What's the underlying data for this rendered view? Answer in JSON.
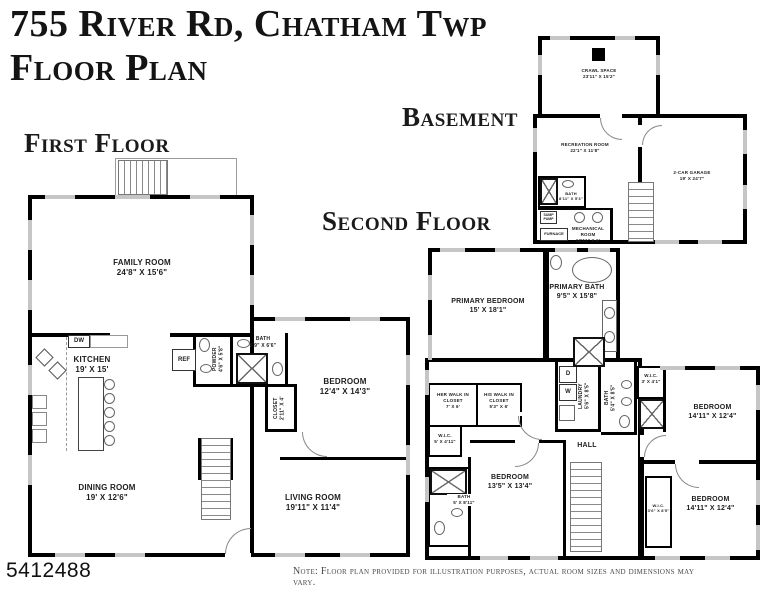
{
  "title": {
    "line1": "755 River Rd, Chatham Twp",
    "line2": "Floor Plan"
  },
  "section_labels": {
    "first_floor": "First Floor",
    "second_floor": "Second Floor",
    "basement": "Basement"
  },
  "colors": {
    "wall": "#000000",
    "window": "#c6c6c6",
    "background": "#ffffff"
  },
  "first_floor": {
    "family_room": {
      "name": "FAMILY ROOM",
      "dims": "24'8\" X 15'6\""
    },
    "kitchen": {
      "name": "KITCHEN",
      "dims": "19' X 15'"
    },
    "dishwasher_label": "DW",
    "refrigerator_label": "REF",
    "powder": {
      "name": "POWDER",
      "dims": "4'6\" X 5'8\""
    },
    "bath": {
      "name": "BATH",
      "dims": "8'9\" X 6'6\""
    },
    "closet": {
      "name": "CLOSET",
      "dims": "2'11\" X 4'"
    },
    "bedroom": {
      "name": "BEDROOM",
      "dims": "12'4\" X 14'3\""
    },
    "dining_room": {
      "name": "DINING ROOM",
      "dims": "19' X 12'6\""
    },
    "living_room": {
      "name": "LIVING ROOM",
      "dims": "19'11\" X 11'4\""
    }
  },
  "second_floor": {
    "primary_bedroom": {
      "name": "PRIMARY BEDROOM",
      "dims": "15' X 18'1\""
    },
    "primary_bath": {
      "name": "PRIMARY BATH",
      "dims": "9'5\" X 15'8\""
    },
    "her_closet": {
      "name": "HER WALK IN CLOSET",
      "dims": "7' X 6'"
    },
    "his_closet": {
      "name": "HIS WALK IN CLOSET",
      "dims": "5'3\" X 6'"
    },
    "wic_left": {
      "name": "W.I.C.",
      "dims": "5' X 4'11\""
    },
    "laundry": {
      "name": "LAUNDRY",
      "dims": "5'6\" X 8'5\""
    },
    "dryer_label": "D",
    "washer_label": "W",
    "bath_middle": {
      "name": "BATH",
      "dims": "5'4\" X 8'5\""
    },
    "wic_right": {
      "name": "W.I.C.",
      "dims": "3' X 4'1\""
    },
    "bedroom_upper_right": {
      "name": "BEDROOM",
      "dims": "14'11\" X 12'4\""
    },
    "bedroom_lower_right": {
      "name": "BEDROOM",
      "dims": "14'11\" X 12'4\""
    },
    "bedroom_middle": {
      "name": "BEDROOM",
      "dims": "13'5\" X 13'4\""
    },
    "bath_lower": {
      "name": "BATH",
      "dims": "5' X 8'11\""
    },
    "wic_small": {
      "name": "W.I.C.",
      "dims": "3'6\" X 8'5\""
    },
    "hall_label": "HALL"
  },
  "basement": {
    "crawl_space": {
      "name": "CRAWL SPACE",
      "dims": "23'11\" X 15'2\""
    },
    "recreation_room": {
      "name": "RECREATION ROOM",
      "dims": "22'1\" X 11'8\""
    },
    "bath": {
      "name": "BATH",
      "dims": "8'11\" X 5'3\""
    },
    "mechanical_room": {
      "name": "MECHANICAL ROOM",
      "dims": "12'11\" X 6'"
    },
    "furnace_label": "FURNACE",
    "sump_pump_label": "SUMP PUMP",
    "garage": {
      "name": "2-CAR GARAGE",
      "dims": "19' X 24'7\""
    }
  },
  "footer": {
    "mls_number": "5412488",
    "note": "Note: Floor plan provided for illustration purposes, actual room sizes and dimensions may vary."
  }
}
